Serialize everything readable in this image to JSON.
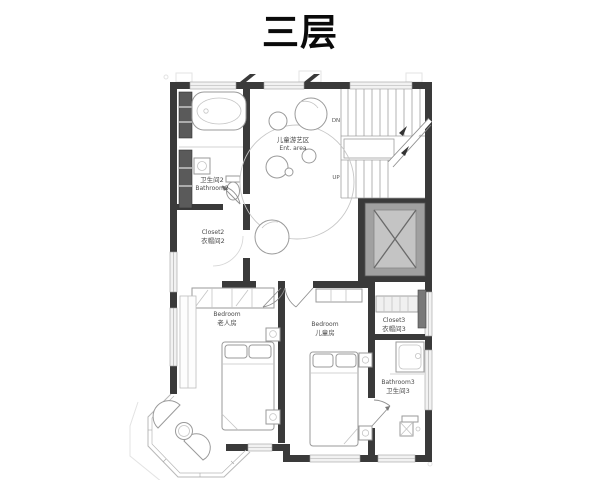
{
  "title": "三层",
  "plan": {
    "rooms": {
      "play_area": {
        "cn": "儿童游艺区",
        "en": "Ent. area"
      },
      "bathroom2": {
        "cn": "卫生间2",
        "en": "Bathroom2"
      },
      "closet2": {
        "en": "Closet2",
        "cn": "衣帽间2"
      },
      "bedroom1": {
        "en": "Bedroom",
        "cn": "老人房"
      },
      "bedroom2": {
        "en": "Bedroom",
        "cn": "儿童房"
      },
      "closet3": {
        "en": "Closet3",
        "cn": "衣帽间3"
      },
      "bathroom3": {
        "en": "Bathroom3",
        "cn": "卫生间3"
      }
    },
    "stairs": {
      "down_label": "DN",
      "up_label": "UP"
    }
  },
  "colors": {
    "wall": "#3a3a3a",
    "furniture_line": "#9a9a9a",
    "elevator_outer": "#a0a0a0",
    "elevator_inner": "#c4c4c4",
    "title_text": "#0a0a0a",
    "label_text": "#4a4a4a",
    "background": "#ffffff"
  }
}
